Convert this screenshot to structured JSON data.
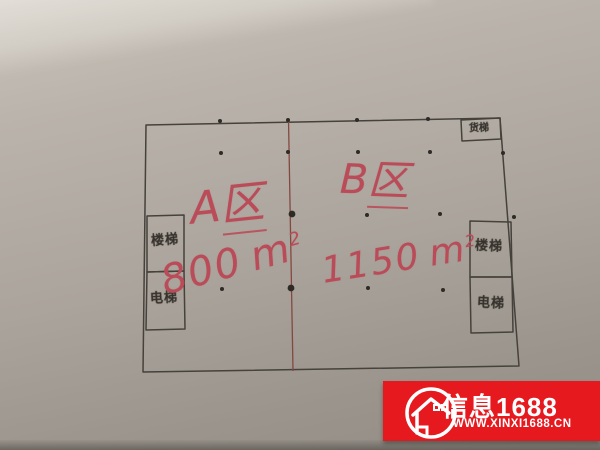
{
  "photo": {
    "description": "Hand-drawn warehouse floor plan sketched on paper, photographed",
    "paper_color": "#aba49c",
    "pencil_color": "#45413b",
    "divider_color": "#84483f",
    "ink_color": "#b94c58"
  },
  "plan": {
    "zone_a": {
      "letter": "A",
      "suffix": "区",
      "area_value": "800",
      "area_unit": "m",
      "area_exponent": "2"
    },
    "zone_b": {
      "letter": "B",
      "suffix": "区",
      "area_value": "1150",
      "area_unit": "m",
      "area_exponent": "2"
    },
    "rooms": {
      "left_top": "楼梯",
      "left_bottom": "电梯",
      "right_top": "楼梯",
      "right_bottom": "电梯",
      "top_right": "货梯"
    },
    "columns": [
      [
        220,
        121
      ],
      [
        288,
        120
      ],
      [
        357,
        120
      ],
      [
        428,
        119
      ],
      [
        221,
        153
      ],
      [
        288,
        152
      ],
      [
        358,
        152
      ],
      [
        430,
        152
      ],
      [
        503,
        153
      ],
      [
        215,
        216
      ],
      [
        367,
        215
      ],
      [
        440,
        214
      ],
      [
        514,
        217
      ],
      [
        222,
        289
      ],
      [
        368,
        288
      ],
      [
        443,
        290
      ]
    ],
    "columns_major": [
      [
        292,
        214
      ],
      [
        291,
        288
      ]
    ]
  },
  "watermark": {
    "brand": "信息1688",
    "website": "WWW.XINXI1688.CN",
    "background": "#e6191f",
    "icon": "house-in-circle-icon"
  }
}
